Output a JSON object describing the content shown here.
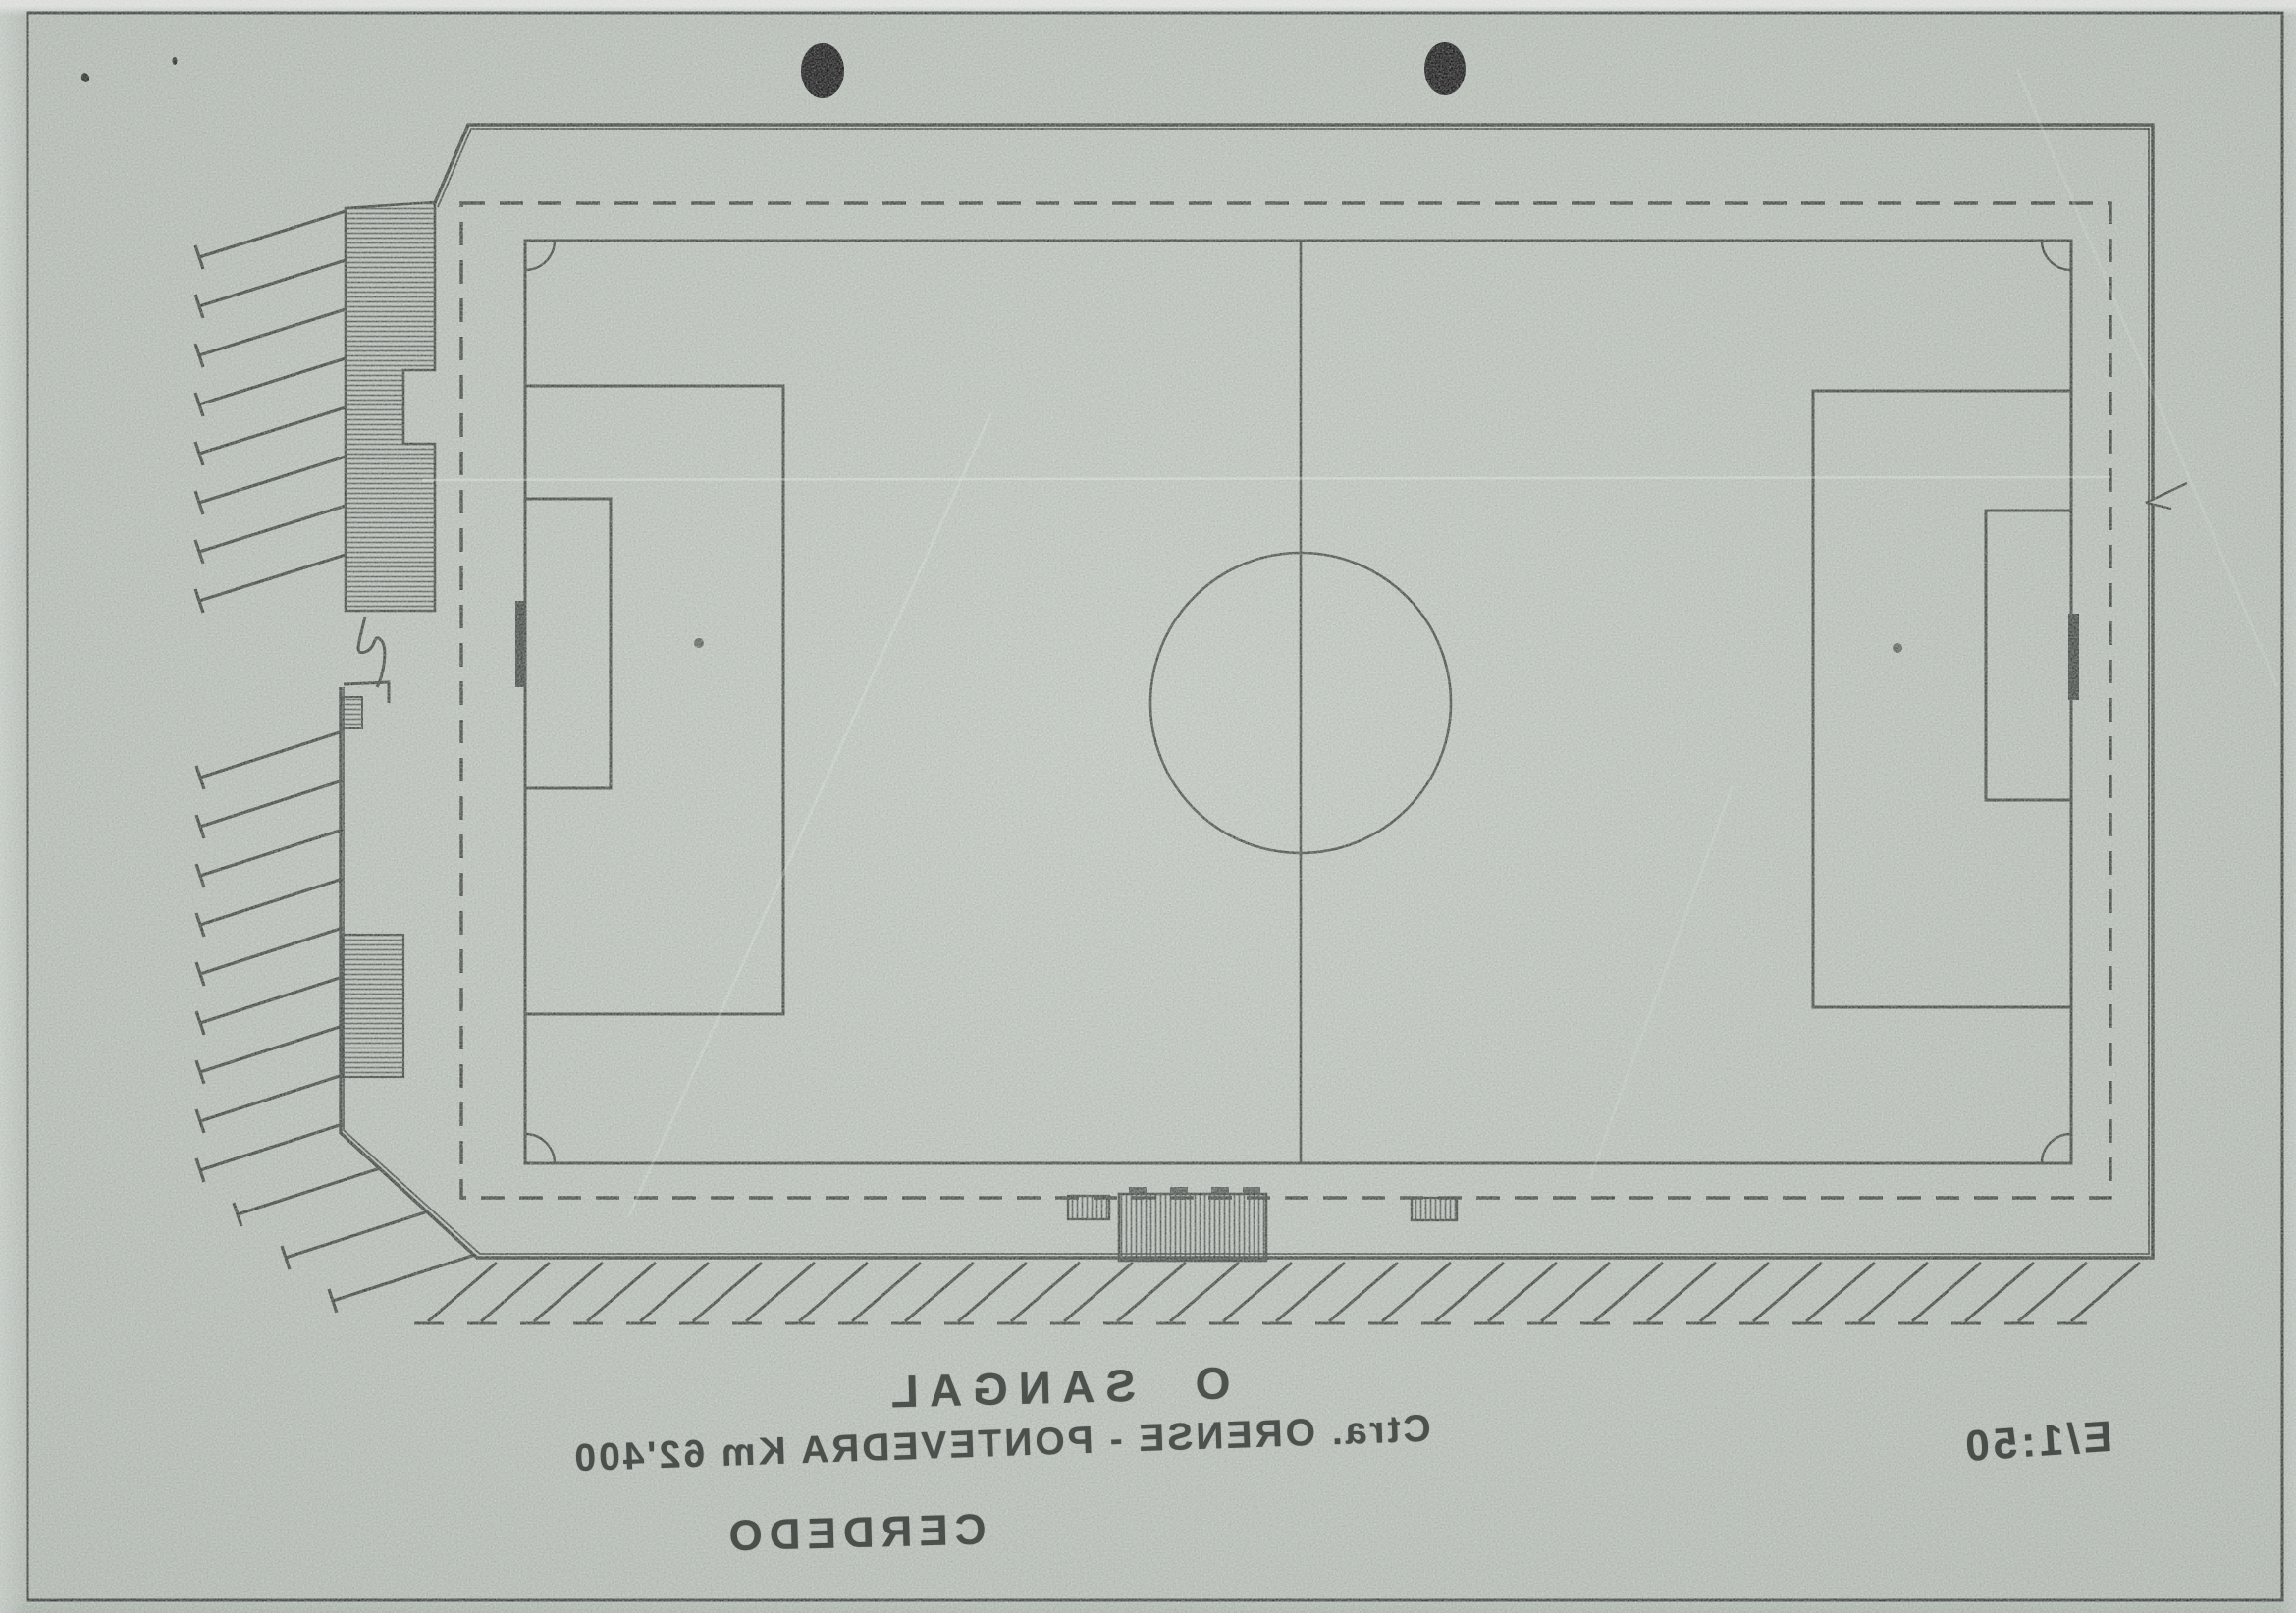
{
  "sheet": {
    "colors": {
      "paper": "#b7beb7",
      "ink": "#3a3f3b",
      "punch_hole": "#0b0b0b"
    },
    "title_block": {
      "club": "O SANGAL",
      "road": "Ctra. ORENSE - PONTEVEDRA Km 62'400",
      "town": "CERDEDO",
      "scale": "E/1:50"
    }
  }
}
